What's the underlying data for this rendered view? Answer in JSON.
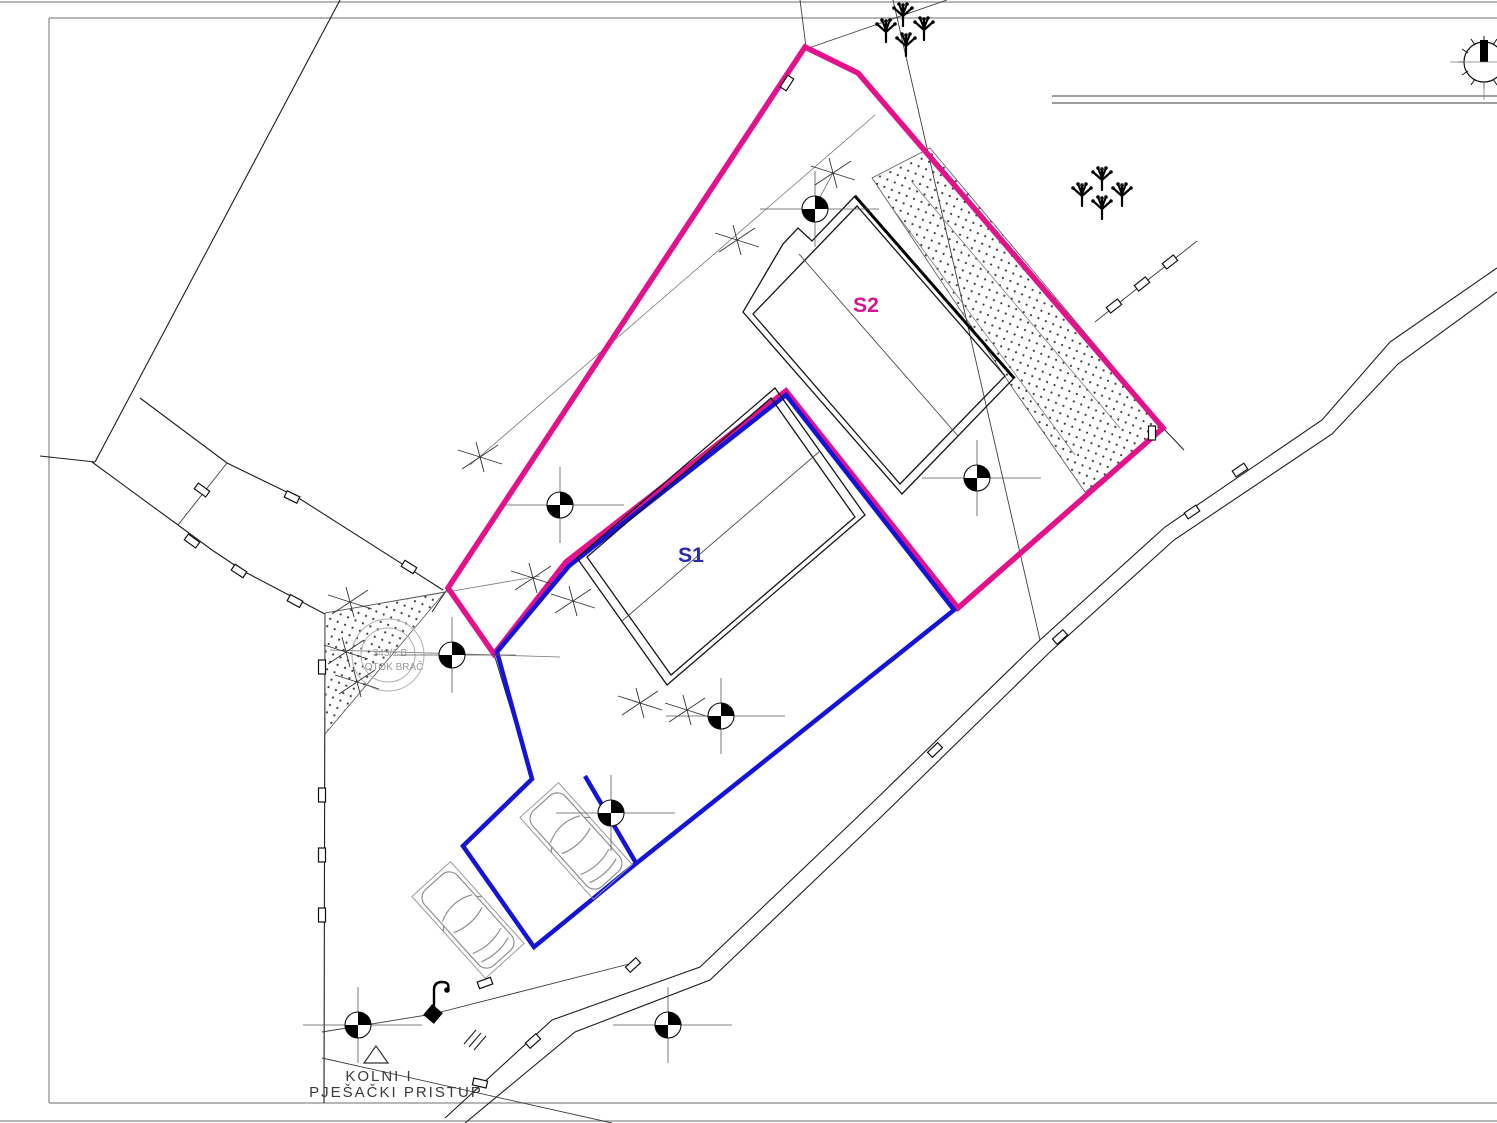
{
  "labels": {
    "s1": "S1",
    "s2": "S2",
    "access_line1": "KOLNI I",
    "access_line2": "PJEŠAČKI PRISTUP",
    "parcel_note_line1": "343/1 B",
    "parcel_note_line2": "OTOK BRAČ"
  },
  "colors": {
    "boundary_magenta": "#e3118b",
    "boundary_blue": "#1414d9",
    "label_blue": "#2929b3",
    "label_magenta": "#d9138f",
    "drawing_dark": "#1e1e1e",
    "drawing_gray": "#8a8a8a",
    "note_gray": "#9a9a9a"
  },
  "icons": {
    "compass": "north-compass-icon",
    "lamp": "street-lamp-icon",
    "tree": "shrub-symbol",
    "control_point": "survey-control-point",
    "triangle": "access-direction-triangle"
  }
}
